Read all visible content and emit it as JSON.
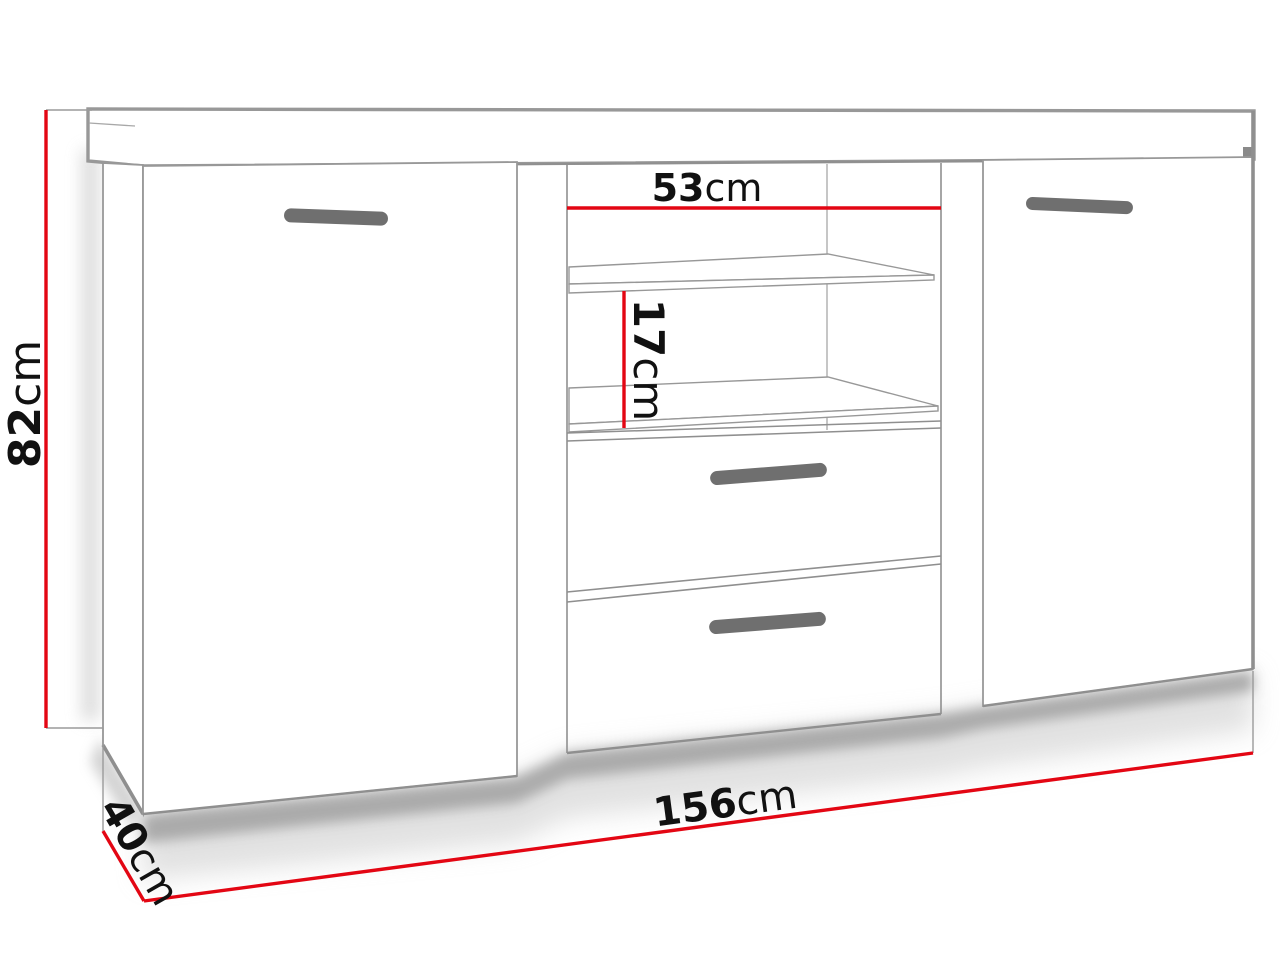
{
  "diagram": {
    "subject": "sideboard-dimension-drawing",
    "labels": {
      "height": {
        "value": "82",
        "unit": "cm"
      },
      "inner_width": {
        "value": "53",
        "unit": "cm"
      },
      "shelf_gap": {
        "value": "17",
        "unit": "cm"
      },
      "total_width": {
        "value": "156",
        "unit": "cm"
      },
      "depth": {
        "value": "40",
        "unit": "cm"
      }
    },
    "colors": {
      "dimension_line": "#e30613",
      "extension_line": "#9a9a9a",
      "furniture_line": "#8f8f8f",
      "handle_fill": "#6f6f6f",
      "label_text": "#111111",
      "background": "#ffffff"
    }
  }
}
